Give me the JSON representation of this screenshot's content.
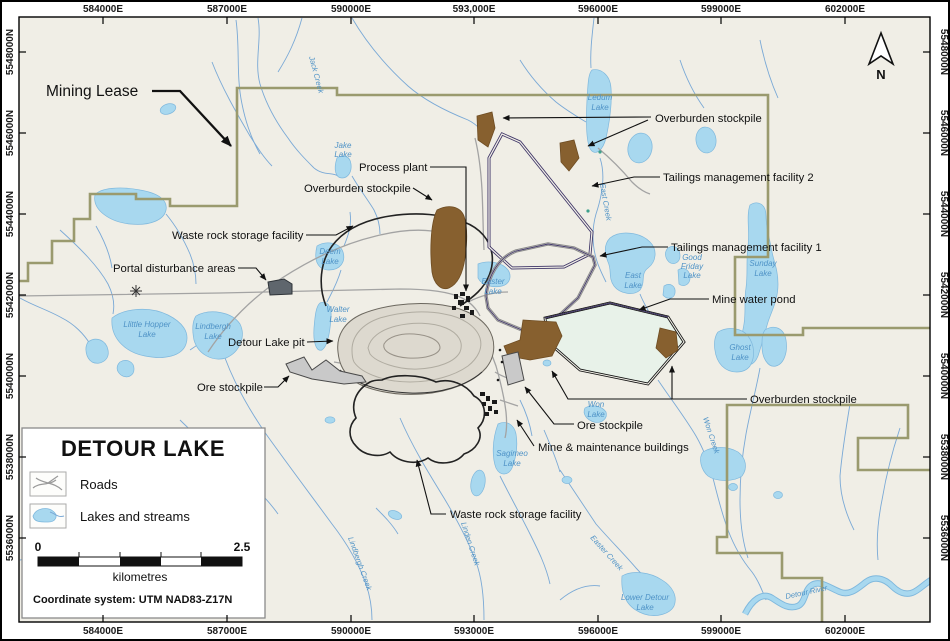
{
  "colors": {
    "map_background": "#f0eee6",
    "lake_fill": "#a8d8ef",
    "stream": "#7aa9d6",
    "mining_lease_line": "#9a9a6e",
    "tailings_outline": "#3d3366",
    "overburden_fill": "#87602f",
    "mine_water_pond_fill": "#e8f2e9",
    "ore_stockpile_fill": "#c9c9c9",
    "portal_fill": "#5f666d",
    "water_label": "#4e92c6"
  },
  "axes": {
    "top": [
      "584000E",
      "587000E",
      "590000E",
      "593,000E",
      "596000E",
      "599000E",
      "602000E"
    ],
    "bottom": [
      "584000E",
      "587000E",
      "590000E",
      "593000E",
      "596000E",
      "599000E",
      "602000E"
    ],
    "left": [
      "5548000N",
      "5546000N",
      "5544000N",
      "5542000N",
      "5540000N",
      "5538000N",
      "5536000N"
    ],
    "right": [
      "5548000N",
      "5546000N",
      "5544000N",
      "5542000N",
      "5540000N",
      "5538000N",
      "5536000N"
    ]
  },
  "compass": "N",
  "facilities": {
    "mining_lease": "Mining Lease",
    "overburden_top": "Overburden stockpile",
    "process_plant": "Process plant",
    "overburden_mid": "Overburden stockpile",
    "waste_rock_top": "Waste rock storage facility",
    "portal": "Portal disturbance areas",
    "detour_pit": "Detour Lake pit",
    "ore_left": "Ore stockpile",
    "tmf2": "Tailings management facility 2",
    "tmf1": "Tailings management facility 1",
    "mine_water_pond": "Mine water pond",
    "overburden_br": "Overburden stockpile",
    "ore_right": "Ore stockpile",
    "mine_buildings": "Mine & maintenance buildings",
    "waste_rock_bottom": "Waste rock storage facility"
  },
  "water": {
    "jack_creek": "Jack Creek",
    "jake_1": "Jake",
    "jake_2": "Lake",
    "ledum_1": "Ledum",
    "ledum_2": "Lake",
    "little_hopper_1": "Llittle Hopper",
    "little_hopper_2": "Lake",
    "lindbergh_1": "Lindbergh",
    "lindbergh_2": "Lake",
    "walter_1": "Walter",
    "walter_2": "Lake",
    "deem_1": "Deem",
    "deem_2": "Lake",
    "easter_1": "Easter",
    "easter_2": "Lake",
    "east_creek": "East Creek",
    "east_lake_1": "East",
    "east_lake_2": "Lake",
    "good_friday_1": "Good",
    "good_friday_2": "Friday",
    "good_friday_3": "Lake",
    "sunday_1": "Sunday",
    "sunday_2": "Lake",
    "ghost_1": "Ghost",
    "ghost_2": "Lake",
    "won_lake_1": "Won",
    "won_lake_2": "Lake",
    "won_creek": "Won Creek",
    "sagimeo_1": "Sagimeo",
    "sagimeo_2": "Lake",
    "linden_creek": "Linden Creek",
    "lindbergh_creek": "Lindbergh Creek",
    "easter_creek": "Easter Creek",
    "lower_detour_1": "Lower Detour",
    "lower_detour_2": "Lake",
    "detour_river": "Detour River"
  },
  "legend": {
    "title": "DETOUR LAKE",
    "roads": "Roads",
    "lakes": "Lakes and streams",
    "scale_start": "0",
    "scale_end": "2.5",
    "scale_units": "kilometres",
    "coordinate_system": "Coordinate system: UTM NAD83-Z17N"
  }
}
